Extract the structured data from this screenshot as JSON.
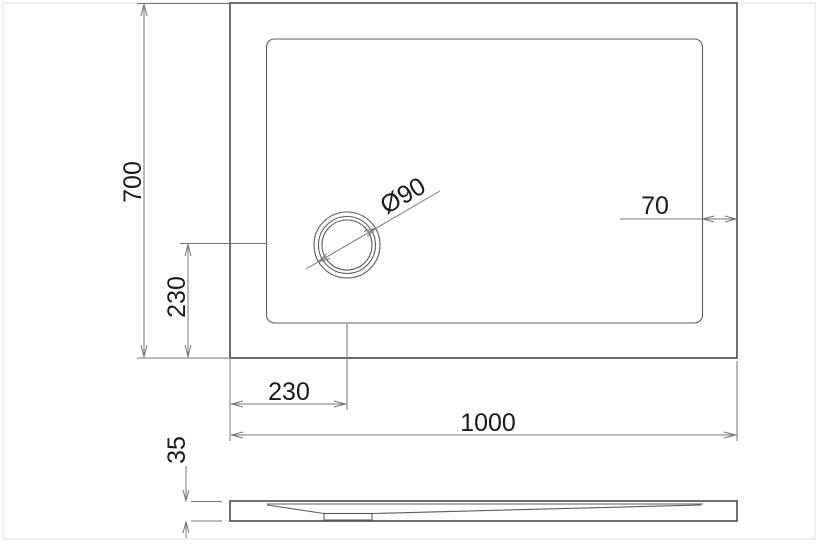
{
  "drawing": {
    "colors": {
      "line": "#4c4c4c",
      "dimension_line": "#757575",
      "text": "#1a1a1a",
      "page_border": "#e2e2e2",
      "background": "#ffffff"
    },
    "labels": {
      "overall_depth": "700",
      "overall_width": "1000",
      "drain_offset_from_bottom": "230",
      "drain_offset_from_left": "230",
      "rim_border_width": "70",
      "drain_diameter": "Ø90",
      "tray_height": "35"
    }
  }
}
